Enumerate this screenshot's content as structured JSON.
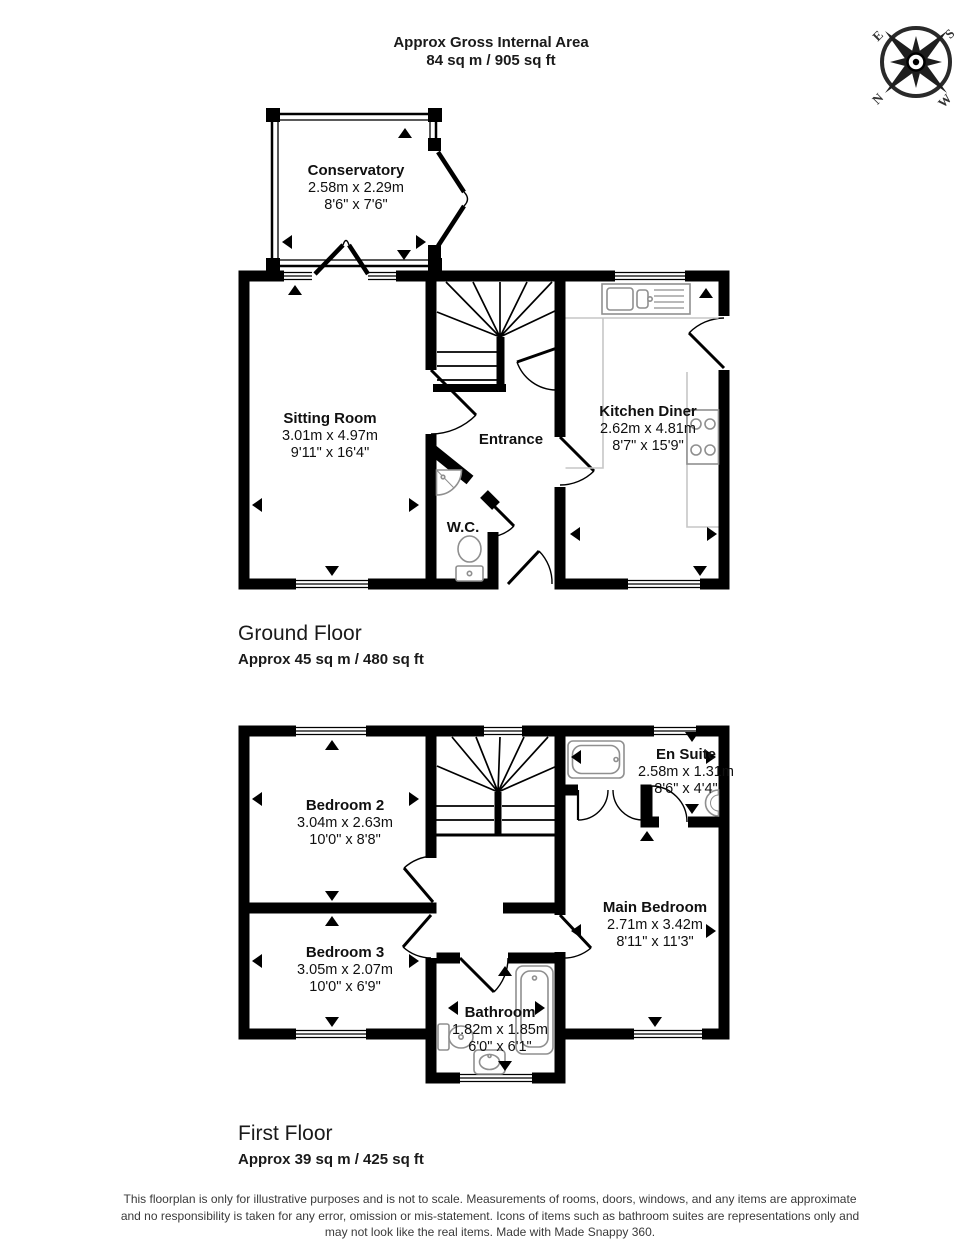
{
  "header": {
    "title": "Approx Gross Internal Area",
    "subtitle": "84 sq m / 905 sq ft"
  },
  "compass": {
    "n": "N",
    "e": "E",
    "s": "S",
    "w": "W"
  },
  "ground_floor": {
    "heading": "Ground Floor",
    "area": "Approx 45 sq m / 480 sq ft",
    "rooms": {
      "conservatory": {
        "name": "Conservatory",
        "metric": "2.58m x 2.29m",
        "imperial": "8'6\" x 7'6\""
      },
      "sitting_room": {
        "name": "Sitting Room",
        "metric": "3.01m x 4.97m",
        "imperial": "9'11\" x 16'4\""
      },
      "entrance": {
        "name": "Entrance"
      },
      "wc": {
        "name": "W.C."
      },
      "kitchen_diner": {
        "name": "Kitchen Diner",
        "metric": "2.62m x 4.81m",
        "imperial": "8'7\" x 15'9\""
      }
    }
  },
  "first_floor": {
    "heading": "First Floor",
    "area": "Approx 39 sq m / 425 sq ft",
    "rooms": {
      "bedroom_2": {
        "name": "Bedroom 2",
        "metric": "3.04m x 2.63m",
        "imperial": "10'0\" x 8'8\""
      },
      "en_suite": {
        "name": "En Suite",
        "metric": "2.58m x 1.31m",
        "imperial": "8'6\" x 4'4\""
      },
      "main_bedroom": {
        "name": "Main Bedroom",
        "metric": "2.71m x 3.42m",
        "imperial": "8'11\" x 11'3\""
      },
      "bedroom_3": {
        "name": "Bedroom 3",
        "metric": "3.05m x 2.07m",
        "imperial": "10'0\" x 6'9\""
      },
      "bathroom": {
        "name": "Bathroom",
        "metric": "1.82m x 1.85m",
        "imperial": "6'0\" x 6'1\""
      }
    }
  },
  "footer": {
    "line1": "This floorplan is only for illustrative purposes and is not to scale. Measurements of rooms, doors, windows, and any items are approximate",
    "line2": "and no responsibility is taken for any error, omission or mis-statement. Icons of items such as bathroom suites are representations only and",
    "line3": "may not look like the real items. Made with Made Snappy 360."
  },
  "colors": {
    "wall": "#000000",
    "fixture": "#8f8f8f",
    "counter": "#c6c6c6",
    "text": "#111111",
    "footer_text": "#3a3a3a"
  }
}
